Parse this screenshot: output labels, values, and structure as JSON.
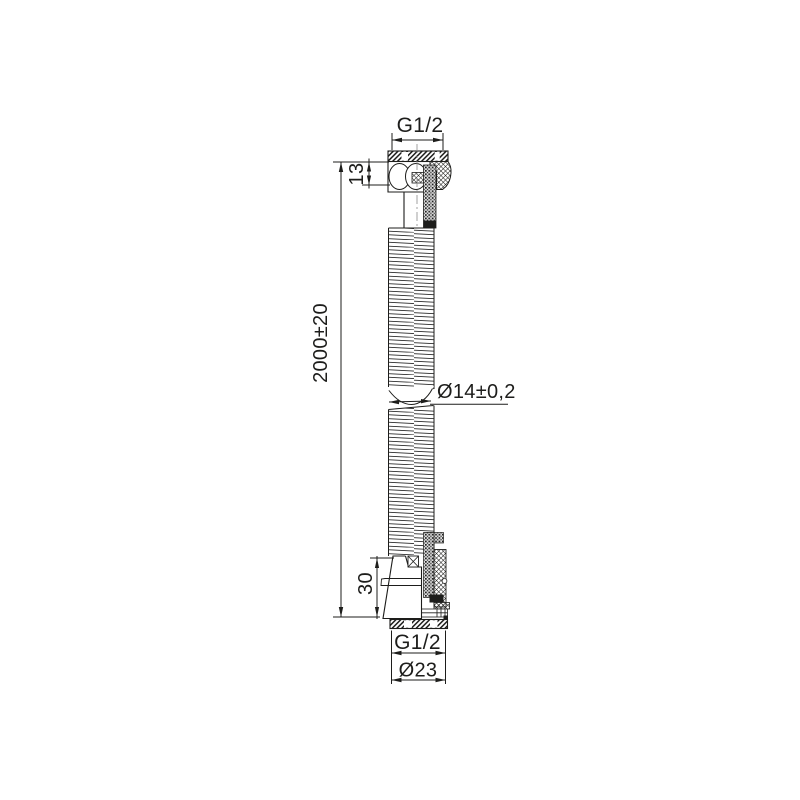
{
  "drawing": {
    "labels": {
      "thread_top": "G1/2",
      "fitting_top_height": "13",
      "hose_length": "2000±20",
      "hose_diameter": "Ø14±0,2",
      "fitting_bottom_height": "30",
      "thread_bottom": "G1/2",
      "nut_diameter": "Ø23"
    },
    "colors": {
      "line": "#1d1d1b",
      "background": "#ffffff"
    }
  }
}
